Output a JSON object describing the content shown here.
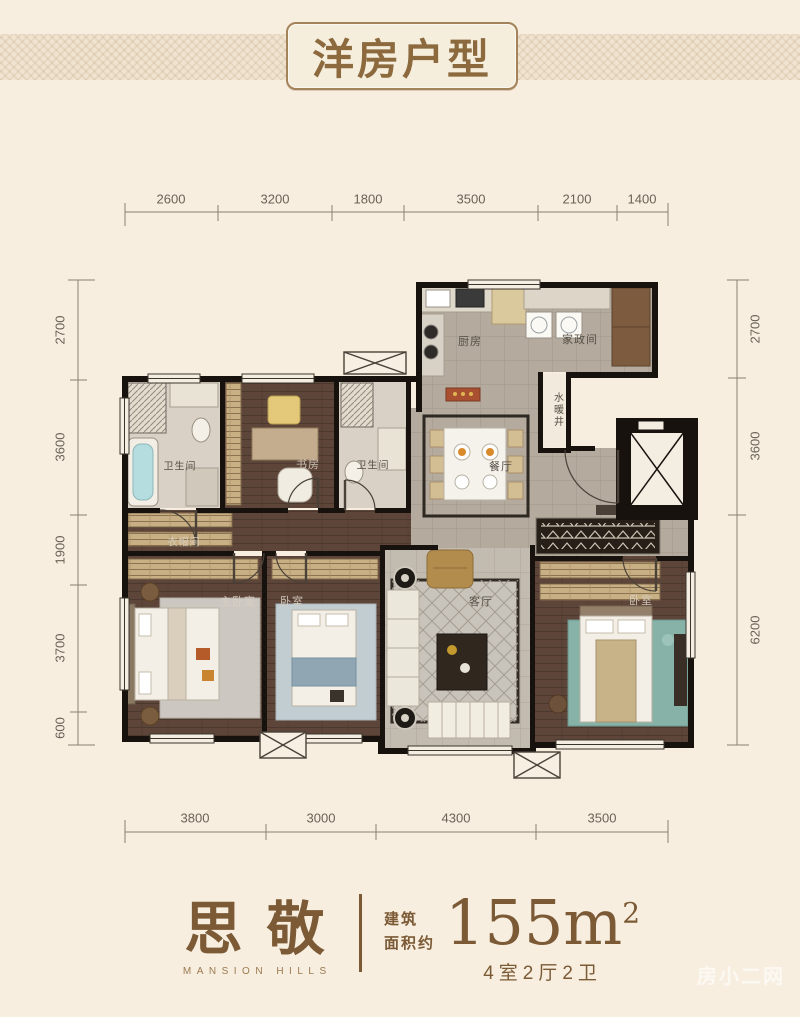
{
  "title": "洋房户型",
  "dims": {
    "top": [
      "2600",
      "3200",
      "1800",
      "3500",
      "2100",
      "1400"
    ],
    "bottom": [
      "3800",
      "3000",
      "4300",
      "3500"
    ],
    "left": [
      "2700",
      "3600",
      "1900",
      "3700",
      "600"
    ],
    "right": [
      "2700",
      "3600",
      "6200"
    ]
  },
  "rooms": {
    "kitchen": "厨房",
    "laundry": "家政间",
    "shaft": "水暖井",
    "dining": "餐厅",
    "bath1": "卫生间",
    "study": "书房",
    "bath2": "卫生间",
    "cloak": "衣帽间",
    "master": "主卧室",
    "bed2": "卧室",
    "living": "客厅",
    "bed3": "卧室"
  },
  "footer": {
    "brand": "思敬",
    "brand_en": "MANSION HILLS",
    "area_label_1": "建筑",
    "area_label_2": "面积约",
    "area_value": "155m",
    "area_sup": "2",
    "spec": "4室2厅2卫"
  },
  "watermark": "房小二网",
  "colors": {
    "background": "#f7eee0",
    "wall": "#17120e",
    "wood_floor": "#5e4539",
    "tile_floor": "#b6ada1",
    "accent_brown": "#7b5a35",
    "title_text": "#8c6a3e"
  }
}
